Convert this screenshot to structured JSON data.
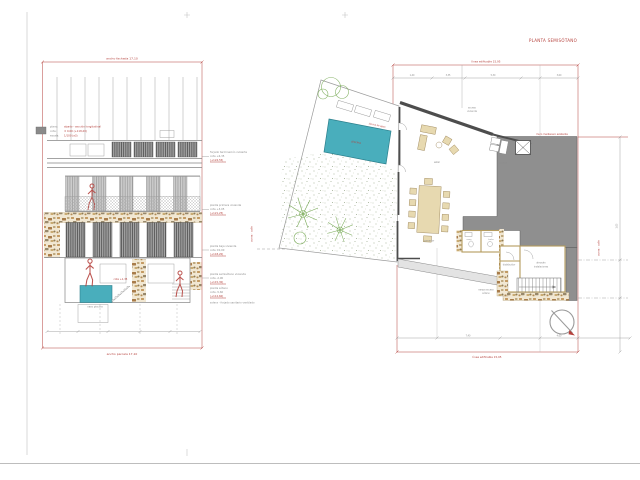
{
  "plan": {
    "title": "PLANTA SEMISÓTANO",
    "dim_top": "línea edificable 15,95",
    "dim_bottom": "línea edificable 15,95",
    "party_wall": "muro medianero existente",
    "pool": {
      "label": "piscina",
      "note": "lámina de agua"
    },
    "rooms": {
      "porche_1": "acceso",
      "porche_2": "vivienda",
      "estar": "estar",
      "comedor": "comedor",
      "cocina": "cocina",
      "distribuidor": "distribuidor",
      "almacen_1": "almacén",
      "almacen_2": "instalaciones",
      "aseo": "aseo",
      "bano": "baño",
      "rampa_1": "rampa acceso",
      "rampa_2": "sótano"
    },
    "streets": {
      "left": "acera · calle",
      "right": "acera · calle"
    },
    "dims": {
      "t1": "1,40",
      "t2": "3,35",
      "t3": "5,30",
      "t4": "3,60",
      "b1": "7,40",
      "b2": "4,60",
      "r1": "1,05"
    }
  },
  "elevation": {
    "dim_top": "ancho fachada 17,10",
    "dim_bottom": "ancho parcela 17,10",
    "info_rows": [
      {
        "label": "plano:",
        "value": "alzado - sección longitudinal"
      },
      {
        "label": "cota:",
        "value": "± 0,00  (+118,20)"
      },
      {
        "label": "escala:",
        "value": "1/100  (a3)"
      }
    ],
    "pool_note": "cota +1,35",
    "basement_label": "vaso piscina",
    "levels": [
      {
        "name": "forjado terminación cubierta",
        "cota": "cota +6,35",
        "ref": "(+124,55)"
      },
      {
        "name": "planta primera vivienda",
        "cota": "cota +3,05",
        "ref": "(+121,25)"
      },
      {
        "name": "planta baja vivienda",
        "cota": "cota ±0,00",
        "ref": "(+118,20)"
      },
      {
        "name": "planta semisótano vivienda",
        "cota": "cota -2,90",
        "ref": "(+115,30)"
      },
      {
        "name": "planta sótano",
        "cota": "cota -5,60",
        "ref": "(+112,60)"
      },
      {
        "name": "solera - forjado sanitario ventilado",
        "cota": "",
        "ref": ""
      }
    ]
  },
  "colors": {
    "accent_red": "#b5413c",
    "pool_teal": "#49aebc",
    "mass_gray": "#8f8f8f",
    "plant_green": "#79ab57",
    "stone_tan": "#c9a972"
  }
}
